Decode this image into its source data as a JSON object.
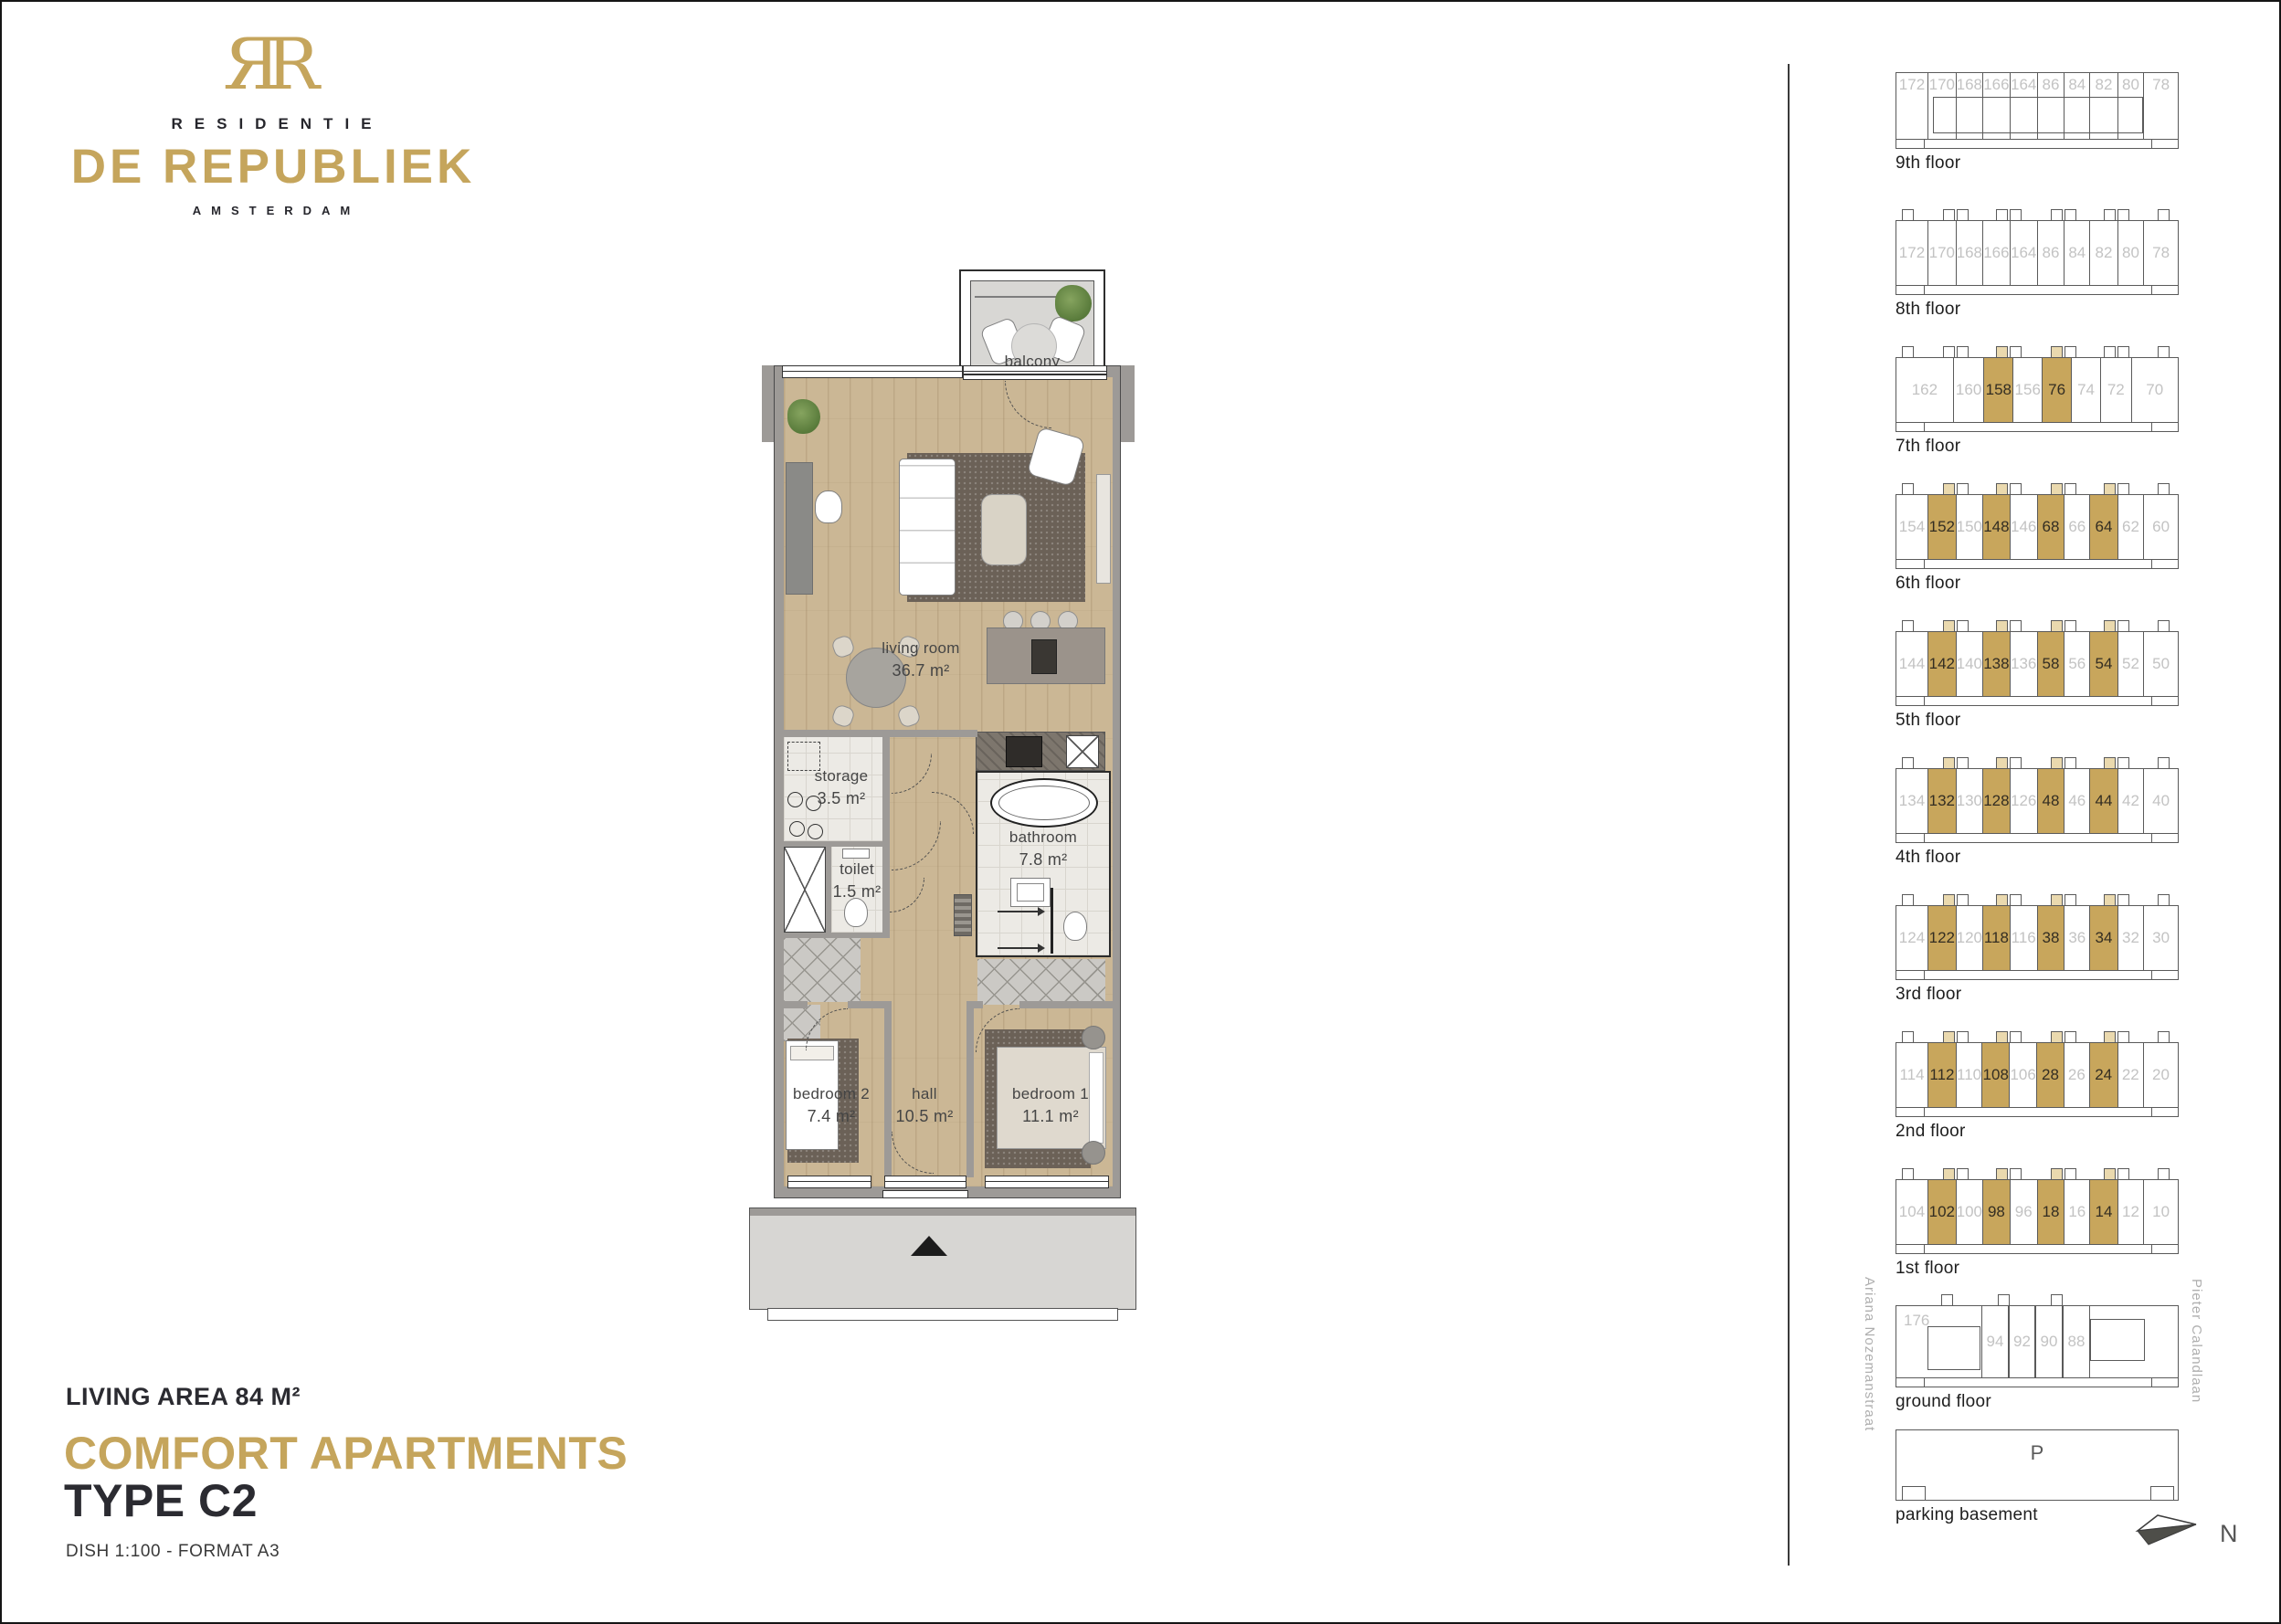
{
  "brand": {
    "monogram": "ЯR",
    "line1": "RESIDENTIE",
    "line2": "DE REPUBLIEK",
    "line3": "AMSTERDAM"
  },
  "title_block": {
    "living_area": "LIVING AREA 84 M²",
    "category": "COMFORT APARTMENTS",
    "type": "TYPE C2",
    "meta": "DISH 1:100  -  FORMAT A3"
  },
  "plan": {
    "rooms": [
      {
        "name": "balcony",
        "area": "5.5 m²"
      },
      {
        "name": "living room",
        "area": "36.7 m²"
      },
      {
        "name": "storage",
        "area": "3.5 m²"
      },
      {
        "name": "toilet",
        "area": "1.5 m²"
      },
      {
        "name": "bathroom",
        "area": "7.8 m²"
      },
      {
        "name": "bedroom 2",
        "area": "7.4 m²"
      },
      {
        "name": "hall",
        "area": "10.5 m²"
      },
      {
        "name": "bedroom 1",
        "area": "11.1 m²"
      }
    ]
  },
  "stack": {
    "streets": {
      "left": "Ariana Nozemanstraat",
      "right": "Pieter Calandlaan"
    },
    "north_label": "N",
    "parking_mark": "P",
    "floors": [
      {
        "label": "9th floor",
        "variant": "ninth",
        "units": [
          {
            "no": "172",
            "hl": false
          },
          {
            "no": "170",
            "hl": false
          },
          {
            "no": "168",
            "hl": false
          },
          {
            "no": "166",
            "hl": false
          },
          {
            "no": "164",
            "hl": false
          },
          {
            "no": "86",
            "hl": false
          },
          {
            "no": "84",
            "hl": false
          },
          {
            "no": "82",
            "hl": false
          },
          {
            "no": "80",
            "hl": false
          },
          {
            "no": "78",
            "hl": false
          }
        ]
      },
      {
        "label": "8th floor",
        "variant": "standard",
        "units": [
          {
            "no": "172",
            "hl": false
          },
          {
            "no": "170",
            "hl": false
          },
          {
            "no": "168",
            "hl": false
          },
          {
            "no": "166",
            "hl": false
          },
          {
            "no": "164",
            "hl": false
          },
          {
            "no": "86",
            "hl": false
          },
          {
            "no": "84",
            "hl": false
          },
          {
            "no": "82",
            "hl": false
          },
          {
            "no": "80",
            "hl": false
          },
          {
            "no": "78",
            "hl": false
          }
        ]
      },
      {
        "label": "7th floor",
        "variant": "seventh",
        "units": [
          {
            "no": "162",
            "hl": false
          },
          {
            "no": "160",
            "hl": false
          },
          {
            "no": "158",
            "hl": true
          },
          {
            "no": "156",
            "hl": false
          },
          {
            "no": "76",
            "hl": true
          },
          {
            "no": "74",
            "hl": false
          },
          {
            "no": "72",
            "hl": false
          },
          {
            "no": "70",
            "hl": false
          }
        ]
      },
      {
        "label": "6th floor",
        "variant": "standard",
        "units": [
          {
            "no": "154",
            "hl": false
          },
          {
            "no": "152",
            "hl": true
          },
          {
            "no": "150",
            "hl": false
          },
          {
            "no": "148",
            "hl": true
          },
          {
            "no": "146",
            "hl": false
          },
          {
            "no": "68",
            "hl": true
          },
          {
            "no": "66",
            "hl": false
          },
          {
            "no": "64",
            "hl": true
          },
          {
            "no": "62",
            "hl": false
          },
          {
            "no": "60",
            "hl": false
          }
        ]
      },
      {
        "label": "5th floor",
        "variant": "standard",
        "units": [
          {
            "no": "144",
            "hl": false
          },
          {
            "no": "142",
            "hl": true
          },
          {
            "no": "140",
            "hl": false
          },
          {
            "no": "138",
            "hl": true
          },
          {
            "no": "136",
            "hl": false
          },
          {
            "no": "58",
            "hl": true
          },
          {
            "no": "56",
            "hl": false
          },
          {
            "no": "54",
            "hl": true
          },
          {
            "no": "52",
            "hl": false
          },
          {
            "no": "50",
            "hl": false
          }
        ]
      },
      {
        "label": "4th floor",
        "variant": "standard",
        "units": [
          {
            "no": "134",
            "hl": false
          },
          {
            "no": "132",
            "hl": true
          },
          {
            "no": "130",
            "hl": false
          },
          {
            "no": "128",
            "hl": true
          },
          {
            "no": "126",
            "hl": false
          },
          {
            "no": "48",
            "hl": true
          },
          {
            "no": "46",
            "hl": false
          },
          {
            "no": "44",
            "hl": true
          },
          {
            "no": "42",
            "hl": false
          },
          {
            "no": "40",
            "hl": false
          }
        ]
      },
      {
        "label": "3rd floor",
        "variant": "standard",
        "units": [
          {
            "no": "124",
            "hl": false
          },
          {
            "no": "122",
            "hl": true
          },
          {
            "no": "120",
            "hl": false
          },
          {
            "no": "118",
            "hl": true
          },
          {
            "no": "116",
            "hl": false
          },
          {
            "no": "38",
            "hl": true
          },
          {
            "no": "36",
            "hl": false
          },
          {
            "no": "34",
            "hl": true
          },
          {
            "no": "32",
            "hl": false
          },
          {
            "no": "30",
            "hl": false
          }
        ]
      },
      {
        "label": "2nd floor",
        "variant": "standard",
        "units": [
          {
            "no": "114",
            "hl": false
          },
          {
            "no": "112",
            "hl": true
          },
          {
            "no": "110",
            "hl": false
          },
          {
            "no": "108",
            "hl": true
          },
          {
            "no": "106",
            "hl": false
          },
          {
            "no": "28",
            "hl": true
          },
          {
            "no": "26",
            "hl": false
          },
          {
            "no": "24",
            "hl": true
          },
          {
            "no": "22",
            "hl": false
          },
          {
            "no": "20",
            "hl": false
          }
        ]
      },
      {
        "label": "1st floor",
        "variant": "standard",
        "units": [
          {
            "no": "104",
            "hl": false
          },
          {
            "no": "102",
            "hl": true
          },
          {
            "no": "100",
            "hl": false
          },
          {
            "no": "98",
            "hl": true
          },
          {
            "no": "96",
            "hl": false
          },
          {
            "no": "18",
            "hl": true
          },
          {
            "no": "16",
            "hl": false
          },
          {
            "no": "14",
            "hl": true
          },
          {
            "no": "12",
            "hl": false
          },
          {
            "no": "10",
            "hl": false
          }
        ]
      },
      {
        "label": "ground floor",
        "variant": "ground",
        "units": [
          {
            "no": "176",
            "hl": false
          },
          {
            "no": "94",
            "hl": false
          },
          {
            "no": "92",
            "hl": false
          },
          {
            "no": "90",
            "hl": false
          },
          {
            "no": "88",
            "hl": false
          }
        ]
      },
      {
        "label": "parking basement",
        "variant": "parking",
        "units": [
          {
            "no": "P",
            "hl": false
          }
        ]
      }
    ]
  },
  "colors": {
    "brand_gold": "#C5A55C",
    "highlight_gold": "#C8A65C",
    "unit_gray": "#C3C3C3"
  }
}
